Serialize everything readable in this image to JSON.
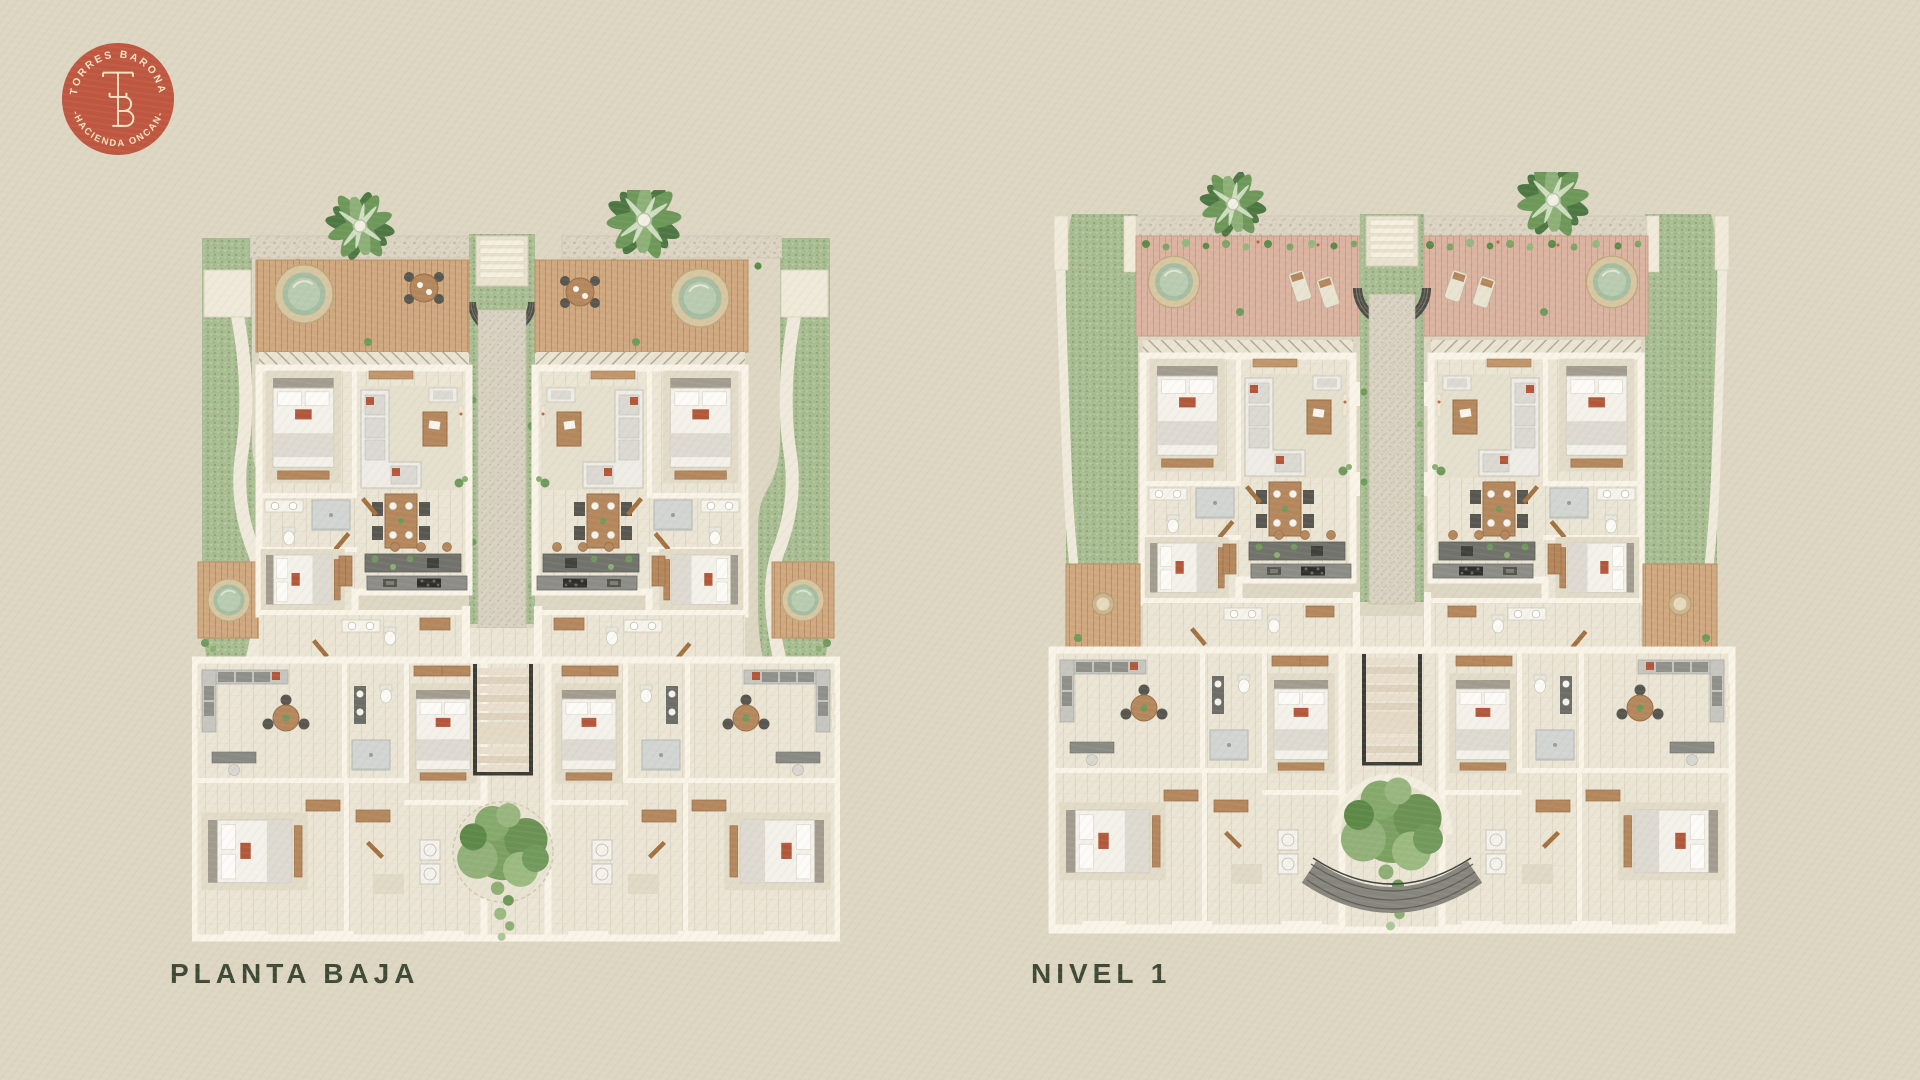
{
  "page": {
    "background_color": "#ddd6c2",
    "description": "Architectural marketing sheet with two rendered floor plans"
  },
  "logo": {
    "arc_top": "TORRES BARONA",
    "arc_bottom": "-HACIENDA ONCAN-",
    "monogram": "TB",
    "badge_color": "#bf5640",
    "text_color": "#f4e3c2"
  },
  "plans": [
    {
      "id": "planta-baja",
      "label": "PLANTA BAJA"
    },
    {
      "id": "nivel-1",
      "label": "NIVEL 1"
    }
  ],
  "typography": {
    "label_color": "#3e4935"
  },
  "palette": {
    "grass": "#a9bd92",
    "gravel": "#ddd5c4",
    "deck_wood": "#cfa87f",
    "terrace_tile": "#dbb4a1",
    "interior_floor": "#ebe5d5",
    "walls": "#f9f4e7",
    "accent_rust": "#b2573a",
    "foliage": "#6d9859"
  }
}
